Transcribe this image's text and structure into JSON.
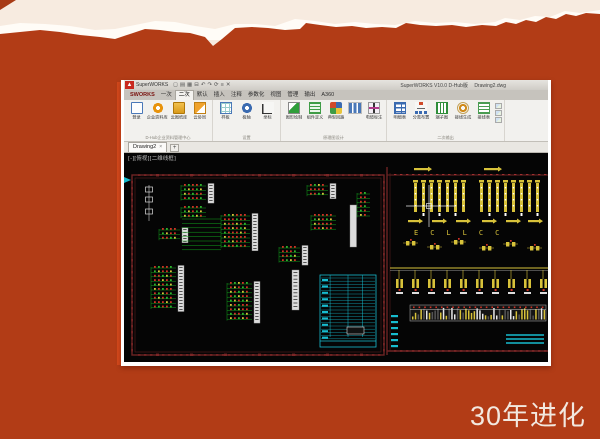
{
  "slide": {
    "caption": "30年进化",
    "background": {
      "base": "#b23c16",
      "cream": "#f7ebe0",
      "tear_white": "#fffcf7",
      "edge_glow": "#d84a1c"
    }
  },
  "window": {
    "titlebar": {
      "app_name": "SuperWORKS",
      "version": "SuperWORKS V10.0 D-Hub版",
      "filename": "Drawing2.dwg",
      "quick_access_icons": [
        "new-icon",
        "open-icon",
        "save-icon",
        "print-icon",
        "undo-icon",
        "redo-icon",
        "refresh-icon",
        "layers-icon",
        "close-icon"
      ]
    },
    "ribbon": {
      "tabs": [
        {
          "label": "SWORKS",
          "active": false,
          "brand": true
        },
        {
          "label": "一次",
          "active": false
        },
        {
          "label": "二次",
          "active": true
        },
        {
          "label": "默认",
          "active": false
        },
        {
          "label": "插入",
          "active": false
        },
        {
          "label": "注释",
          "active": false
        },
        {
          "label": "参数化",
          "active": false
        },
        {
          "label": "视图",
          "active": false
        },
        {
          "label": "管理",
          "active": false
        },
        {
          "label": "输出",
          "active": false
        },
        {
          "label": "A360",
          "active": false
        }
      ],
      "groups": [
        {
          "label": "D-Hub企业资料管理中心",
          "items": [
            {
              "label": "登录",
              "icon": "login-icon"
            },
            {
              "label": "企业资料库",
              "icon": "database-icon"
            },
            {
              "label": "云图纸库",
              "icon": "folder-icon"
            },
            {
              "label": "云协同",
              "icon": "cloud-icon"
            }
          ]
        },
        {
          "label": "设置",
          "items": [
            {
              "label": "样板",
              "icon": "template-icon"
            },
            {
              "label": "极轴",
              "icon": "polar-icon"
            },
            {
              "label": "坐标",
              "icon": "axis-icon"
            }
          ]
        },
        {
          "label": "原理图设计",
          "items": [
            {
              "label": "图形绘制",
              "icon": "draw-icon"
            },
            {
              "label": "组件定义",
              "icon": "component-icon"
            },
            {
              "label": "典型回路",
              "icon": "loop-icon"
            },
            {
              "label": "",
              "icon": "mini-grid-icon"
            },
            {
              "label": "电缆标注",
              "icon": "cable-icon"
            }
          ]
        },
        {
          "label": "二次输出",
          "items": [
            {
              "label": "明细表",
              "icon": "table-icon"
            },
            {
              "label": "分类布置",
              "icon": "tree-icon"
            },
            {
              "label": "端子图",
              "icon": "terminal-icon"
            },
            {
              "label": "接线生成",
              "icon": "generate-icon"
            },
            {
              "label": "接线表",
              "icon": "list-icon"
            }
          ]
        }
      ]
    },
    "doc_tabs": {
      "tabs": [
        {
          "label": "Drawing2",
          "close": "×"
        }
      ],
      "add_button": "+"
    },
    "canvas": {
      "viewport_label": "[-][俯视][二维线框]",
      "colors": {
        "background": "#050505",
        "sheet_border": "#6e2424",
        "tick_red": "#a03030",
        "wire_green": "#12a41c",
        "node_red": "#d23226",
        "node_green": "#2fb32f",
        "accent_yellow": "#d8c23a",
        "table_cyan": "#17bccf",
        "label_white": "#e4e4e4"
      }
    }
  }
}
